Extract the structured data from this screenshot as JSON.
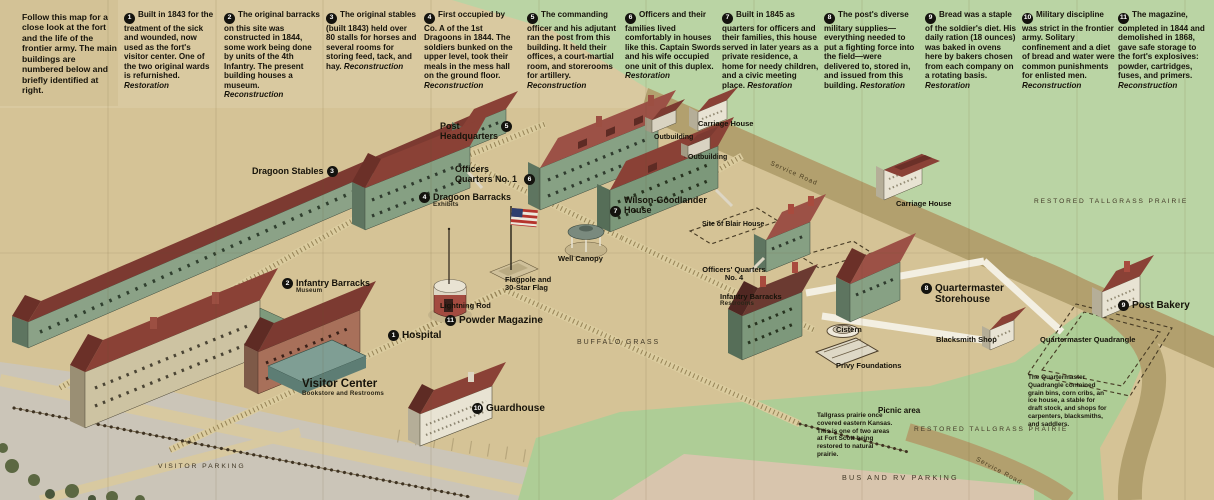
{
  "intro": "Follow this map for a close look at the fort and the life of the frontier army. The main buildings are numbered below and briefly identified at right.",
  "legend": [
    {
      "num": "1",
      "text": "Built in 1843 for the treatment of the sick and wounded, now used as the fort's visitor center. One of the two original wards is refurnished.",
      "tag": "Restoration"
    },
    {
      "num": "2",
      "text": "The original barracks on this site was constructed in 1844, some work being done by units of the 4th Infantry. The present building houses a museum.",
      "tag": "Reconstruction"
    },
    {
      "num": "3",
      "text": "The original stables (built 1843) held over 80 stalls for horses and several rooms for storing feed, tack, and hay.",
      "tag": "Reconstruction"
    },
    {
      "num": "4",
      "text": "First occupied by Co. A of the 1st Dragoons in 1844. The soldiers bunked on the upper level, took their meals in the mess hall on the ground floor.",
      "tag": "Reconstruction"
    },
    {
      "num": "5",
      "text": "The commanding officer and his adjutant ran the post from this building. It held their offices, a court-martial room, and storerooms for artillery.",
      "tag": "Reconstruction"
    },
    {
      "num": "6",
      "text": "Officers and their families lived comfortably in houses like this. Captain Swords and his wife occupied one unit of this duplex.",
      "tag": "Restoration"
    },
    {
      "num": "7",
      "text": "Built in 1845 as quarters for officers and their families, this house served in later years as a private residence, a home for needy children, and a civic meeting place.",
      "tag": "Restoration"
    },
    {
      "num": "8",
      "text": "The post's diverse military supplies—everything needed to put a fighting force into the field—were delivered to, stored in, and issued from this building.",
      "tag": "Restoration"
    },
    {
      "num": "9",
      "text": "Bread was a staple of the soldier's diet. His daily ration (18 ounces) was baked in ovens here by bakers chosen from each company on a rotating basis.",
      "tag": "Restoration"
    },
    {
      "num": "10",
      "text": "Military discipline was strict in the frontier army. Solitary confinement and a diet of bread and water were common punishments for enlisted men.",
      "tag": "Reconstruction"
    },
    {
      "num": "11",
      "text": "The magazine, completed in 1844 and demolished in 1868, gave safe storage to the fort's explosives: powder, cartridges, fuses, and primers.",
      "tag": "Reconstruction"
    }
  ],
  "map_labels": {
    "dragoon_stables": {
      "badge": "3",
      "title": "Dragoon Stables"
    },
    "infantry_barracks_museum": {
      "badge": "2",
      "title": "Infantry Barracks",
      "sub": "Museum"
    },
    "dragoon_barracks": {
      "badge": "4",
      "title": "Dragoon Barracks",
      "sub": "Exhibits"
    },
    "post_headquarters": {
      "badge": "5",
      "title": "Post Headquarters"
    },
    "officers_quarters_1": {
      "badge": "6",
      "title": "Officers Quarters No. 1"
    },
    "wilson_goodlander": {
      "badge": "7",
      "title": "Wilson-Goodlander House"
    },
    "well_canopy": {
      "title": "Well Canopy"
    },
    "flagpole": {
      "title": "Flagpole and 30-Star Flag"
    },
    "lightning_rod": {
      "title": "Lightning Rod"
    },
    "powder_magazine": {
      "badge": "11",
      "title": "Powder Magazine"
    },
    "hospital": {
      "badge": "1",
      "title": "Hospital"
    },
    "visitor_center": {
      "title": "Visitor Center",
      "sub": "Bookstore and Restrooms"
    },
    "guardhouse": {
      "badge": "10",
      "title": "Guardhouse"
    },
    "buffalo_grass": {
      "title": "BUFFALO GRASS"
    },
    "carriage_house_1": {
      "title": "Carriage House"
    },
    "outbuilding_1": {
      "title": "Outbuilding"
    },
    "outbuilding_2": {
      "title": "Outbuilding"
    },
    "service_road_1": {
      "title": "Service Road"
    },
    "restored_tallgrass_1": {
      "title": "RESTORED TALLGRASS PRAIRIE"
    },
    "carriage_house_2": {
      "title": "Carriage House"
    },
    "site_of_blair_house": {
      "title": "Site of Blair House"
    },
    "officers_quarters_4": {
      "title": "Officers' Quarters No. 4"
    },
    "infantry_barracks_restrooms": {
      "title": "Infantry Barracks",
      "sub": "Restrooms"
    },
    "quartermaster_storehouse": {
      "badge": "8",
      "title": "Quartermaster Storehouse"
    },
    "cistern": {
      "title": "Cistern"
    },
    "privy_foundations": {
      "title": "Privy Foundations"
    },
    "blacksmith_shop": {
      "title": "Blacksmith Shop"
    },
    "quartermaster_quadrangle": {
      "title": "Quartermaster Quadrangle"
    },
    "post_bakery": {
      "badge": "9",
      "title": "Post Bakery"
    },
    "picnic_area": {
      "title": "Picnic area"
    },
    "restored_tallgrass_2": {
      "title": "RESTORED TALLGRASS PRAIRIE"
    },
    "bus_rv_parking": {
      "title": "BUS AND RV PARKING"
    },
    "visitor_parking": {
      "title": "VISITOR PARKING"
    },
    "service_road_2": {
      "title": "Service Road"
    }
  },
  "notes": {
    "quartermaster_quadrangle": "The Quartermaster Quadrangle contained grain bins, corn cribs, an ice house, a stable for draft stock, and shops for carpenters, blacksmiths, and saddlers.",
    "tallgrass_prairie": "Tallgrass prairie once covered eastern Kansas. This is one of two areas at Fort Scott being restored to natural prairie."
  }
}
